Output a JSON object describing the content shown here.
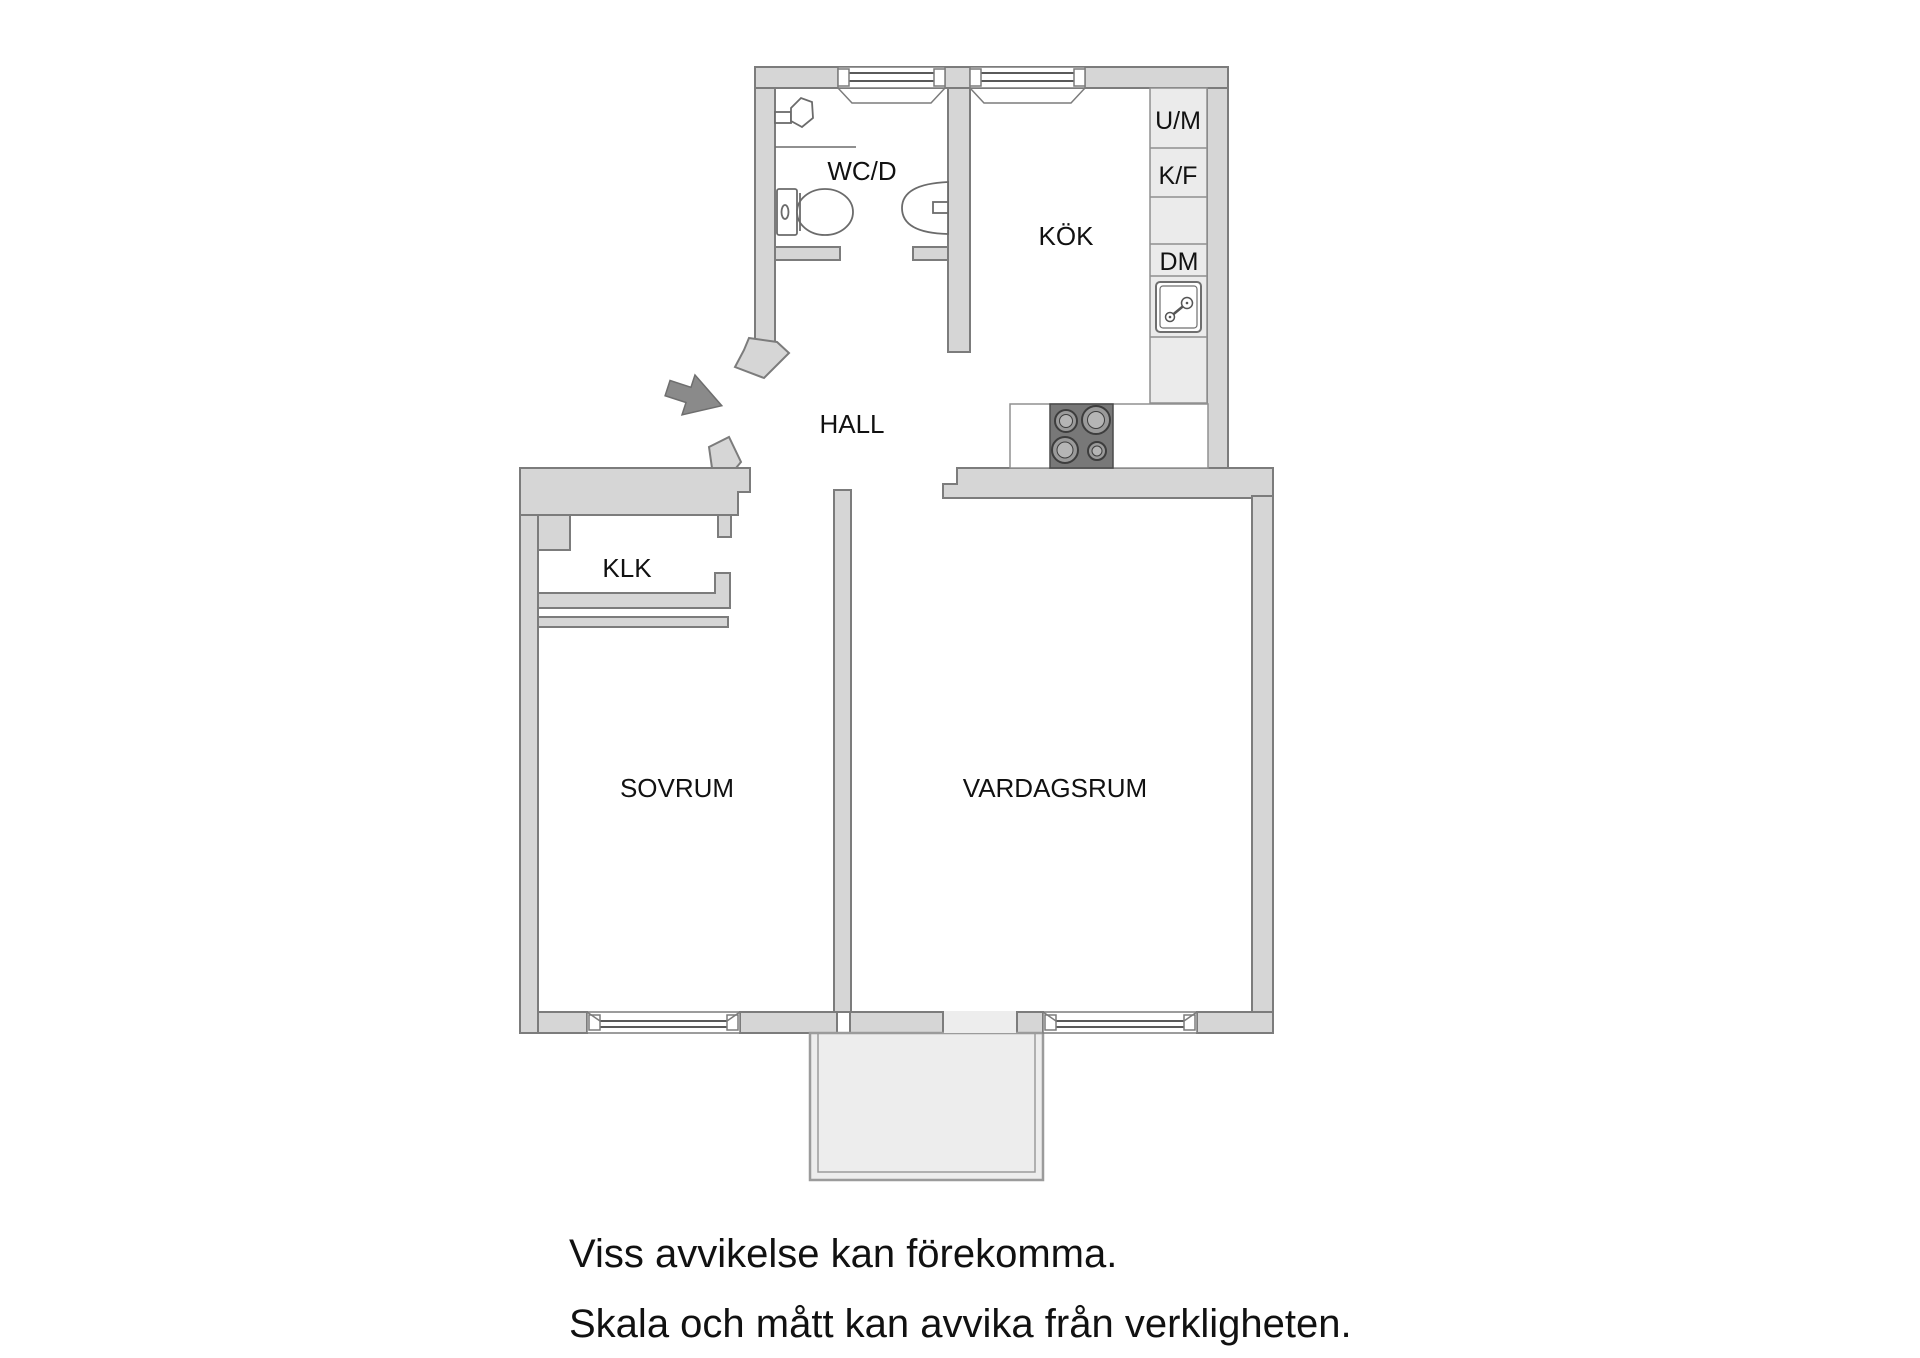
{
  "floorplan": {
    "rooms": {
      "wcd": "WC/D",
      "kok": "KÖK",
      "hall": "HALL",
      "klk": "KLK",
      "sovrum": "SOVRUM",
      "vardagsrum": "VARDAGSRUM"
    },
    "appliances": {
      "um": "U/M",
      "kf": "K/F",
      "dm": "DM"
    },
    "fixtures": [
      "toilet",
      "washbasin",
      "shower-mixer",
      "stove-hob",
      "kitchen-sink",
      "entrance-arrow",
      "balcony",
      "windows"
    ],
    "colors": {
      "wall_fill": "#d6d6d6",
      "wall_stroke": "#7c7c7c",
      "cabinet_fill": "#ebebeb",
      "balcony_fill": "#ededed",
      "stove_fill": "#787878",
      "burner_fill": "#9a9a9a",
      "arrow_fill": "#8a8a8a",
      "glass_line": "#5a5a5a",
      "text": "#111111"
    }
  },
  "disclaimer": {
    "line1": "Viss avvikelse kan förekomma.",
    "line2": "Skala och mått kan avvika från verkligheten."
  }
}
